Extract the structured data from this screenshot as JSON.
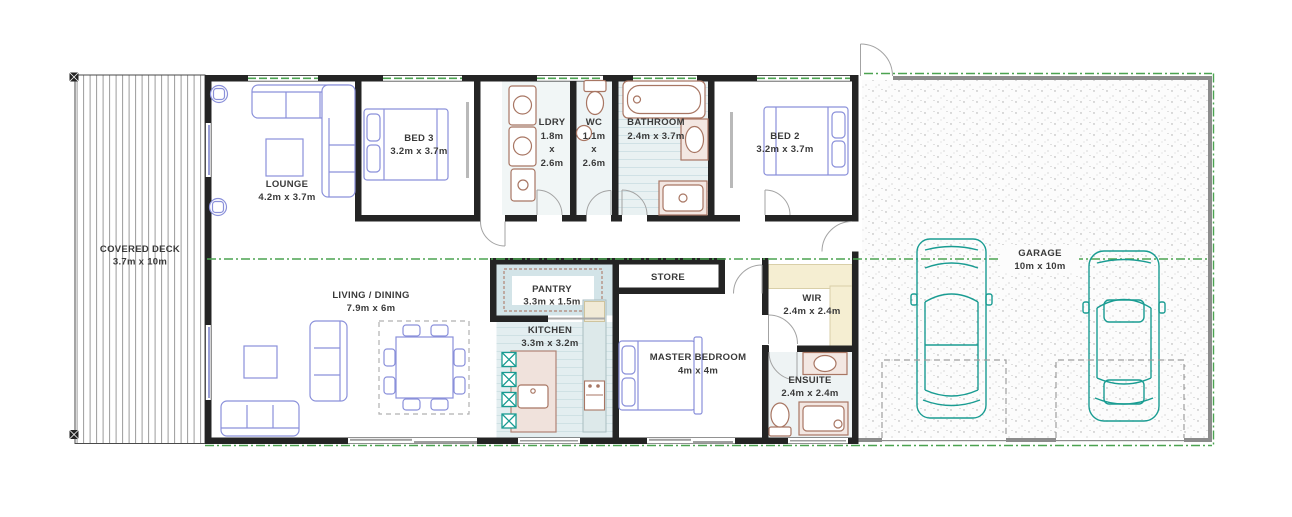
{
  "plan_title": "3 bedroom house floor plan with double garage",
  "rooms": [
    {
      "id": "covered-deck",
      "lines": [
        "COVERED DECK",
        "3.7m x 10m"
      ]
    },
    {
      "id": "lounge",
      "lines": [
        "LOUNGE",
        "4.2m x 3.7m"
      ]
    },
    {
      "id": "bed-3",
      "lines": [
        "BED 3",
        "3.2m x 3.7m"
      ]
    },
    {
      "id": "laundry",
      "lines": [
        "LDRY",
        "1.8m",
        "x",
        "2.6m"
      ]
    },
    {
      "id": "wc",
      "lines": [
        "WC",
        "1.1m",
        "x",
        "2.6m"
      ]
    },
    {
      "id": "bathroom",
      "lines": [
        "BATHROOM",
        "2.4m x 3.7m"
      ]
    },
    {
      "id": "bed-2",
      "lines": [
        "BED 2",
        "3.2m x 3.7m"
      ]
    },
    {
      "id": "living-dining",
      "lines": [
        "LIVING / DINING",
        "7.9m x 6m"
      ]
    },
    {
      "id": "pantry",
      "lines": [
        "PANTRY",
        "3.3m x 1.5m"
      ]
    },
    {
      "id": "kitchen",
      "lines": [
        "KITCHEN",
        "3.3m x 3.2m"
      ]
    },
    {
      "id": "store",
      "lines": [
        "STORE"
      ]
    },
    {
      "id": "master-bedroom",
      "lines": [
        "MASTER BEDROOM",
        "4m x 4m"
      ]
    },
    {
      "id": "wir",
      "lines": [
        "WIR",
        "2.4m x 2.4m"
      ]
    },
    {
      "id": "ensuite",
      "lines": [
        "ENSUITE",
        "2.4m x 2.4m"
      ]
    },
    {
      "id": "garage",
      "lines": [
        "GARAGE",
        "10m x 10m"
      ]
    }
  ],
  "colors": {
    "wall": "#242424",
    "garage_wall": "#8c8c8c",
    "section_green": "#4ca351",
    "furniture_blue": "#8a90da",
    "fixture_brown": "#a87663",
    "car_teal": "#199c92",
    "floor_blue": "#e3eef0",
    "wir_cream": "#f5eed2"
  }
}
